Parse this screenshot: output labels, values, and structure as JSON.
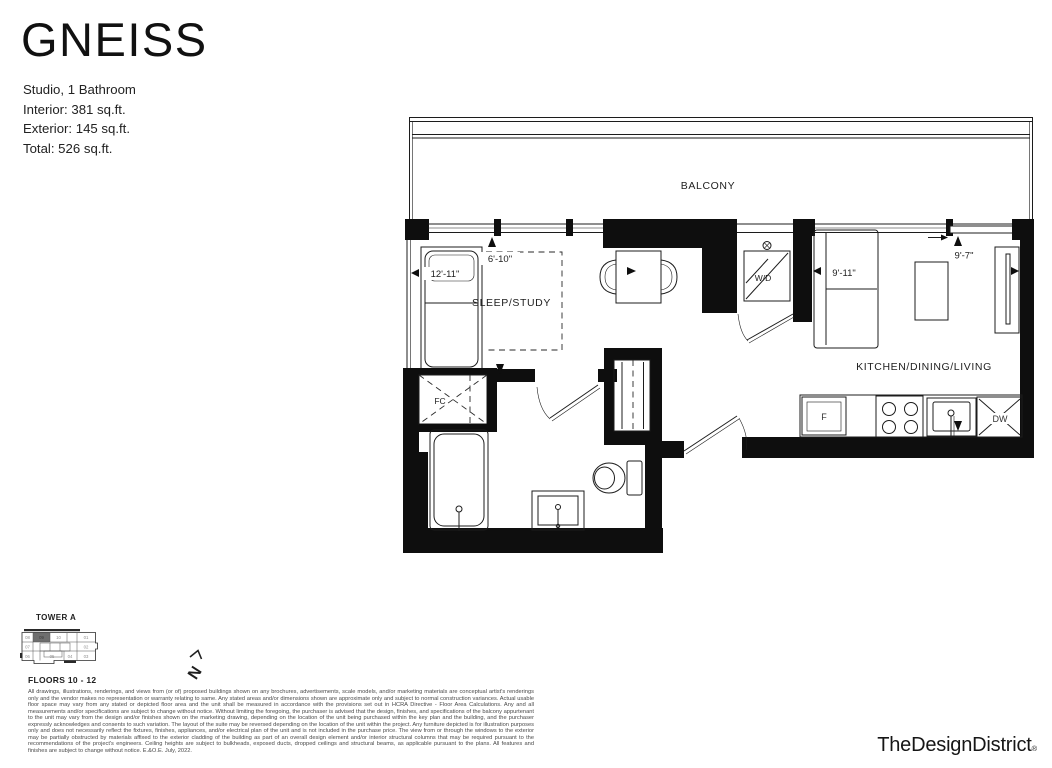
{
  "header": {
    "plan_name": "GNEISS",
    "specs": [
      "Studio, 1 Bathroom",
      "Interior: 381 sq.ft.",
      "Exterior: 145 sq.ft.",
      "Total: 526 sq.ft."
    ]
  },
  "floorplan": {
    "labels": {
      "balcony": "BALCONY",
      "sleep_study": "SLEEP/STUDY",
      "kitchen_dining_living": "KITCHEN/DINING/LIVING",
      "washer_dryer": "W/D",
      "fan_coil": "FC",
      "fridge": "F",
      "dishwasher": "DW"
    },
    "dimensions": {
      "sleep_width": "12'-11\"",
      "sleep_depth": "6'-10\"",
      "living_width": "9'-11\"",
      "living_depth": "9'-7\""
    }
  },
  "keyplan": {
    "tower": "TOWER A",
    "floors": "FLOORS 10 - 12",
    "highlighted_unit": "09",
    "units": [
      "08",
      "09",
      "10",
      "01",
      "07",
      "02",
      "06",
      "05",
      "04",
      "03"
    ],
    "north": "N"
  },
  "footer": {
    "disclaimer": "All drawings, illustrations, renderings, and views from (or of) proposed buildings shown on any brochures, advertisements, scale models, and/or marketing materials are conceptual artist's renderings only and the vendor makes no representation or warranty relating to same. Any stated areas and/or dimensions shown are approximate only and subject to normal construction variances. Actual usable floor space may vary from any stated or depicted floor area and the unit shall be measured in accordance with the provisions set out in HCRA Directive - Floor Area Calculations. Any and all measurements and/or specifications are subject to change without notice. Without limiting the foregoing, the purchaser is advised that the design, finishes, and specifications of the balcony appurtenant to the unit may vary from the design and/or finishes shown on the marketing drawing, depending on the location of the unit being purchased within the key plan and the building, and the purchaser expressly acknowledges and consents to such variation. The layout of the suite may be reversed depending on the location of the unit within the project. Any furniture depicted is for illustration purposes only and does not necessarily reflect the fixtures, finishes, appliances, and/or electrical plan of the unit and is not included in the purchase price. The view from or through the windows to the exterior may be partially obstructed by materials affixed to the exterior cladding of the building as part of an overall design element and/or interior structural columns that may be required pursuant to the recommendations of the project's engineers. Ceiling heights are subject to bulkheads, exposed ducts, dropped ceilings and structural beams, as applicable pursuant to the plans. All features and finishes are subject to change without notice. E.&O.E. July, 2022.",
    "logo": "TheDesignDistrict",
    "logo_reg": "®"
  }
}
